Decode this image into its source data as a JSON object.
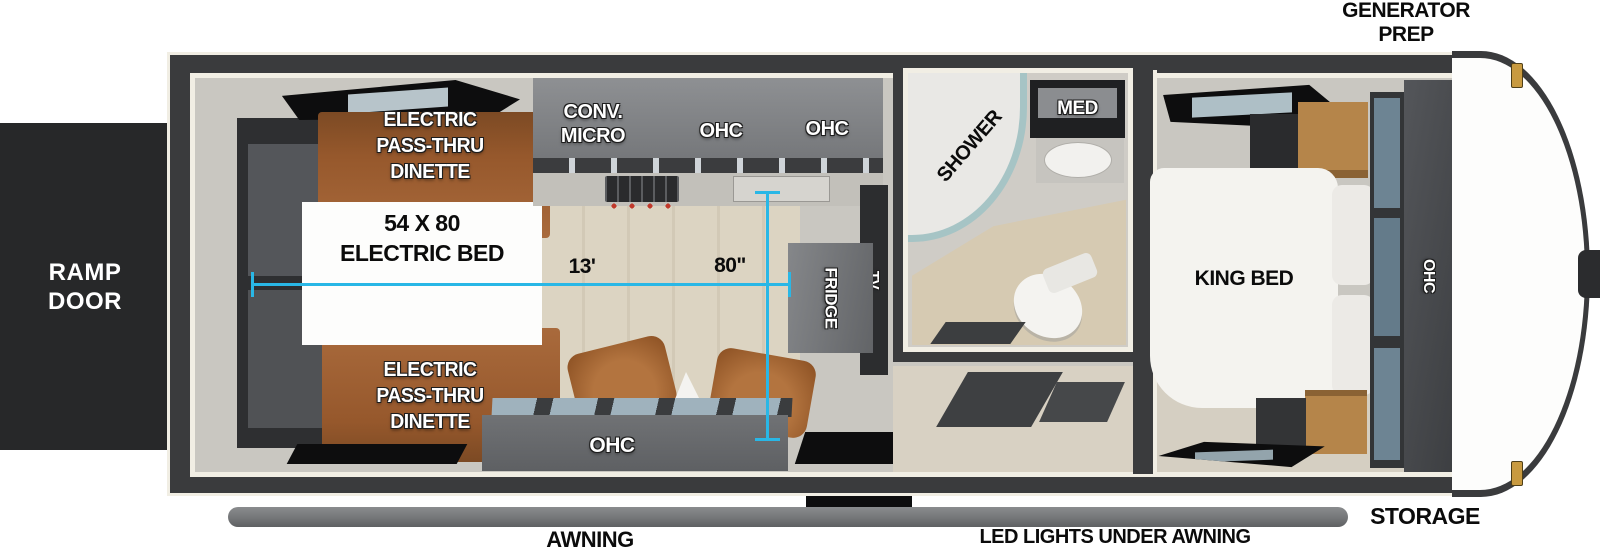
{
  "exterior": {
    "ramp_door": [
      "RAMP",
      "DOOR"
    ],
    "generator_prep": [
      "GENERATOR",
      "PREP"
    ],
    "storage": "STORAGE",
    "awning": "AWNING",
    "led_lights": "LED LIGHTS UNDER AWNING"
  },
  "garage": {
    "dinette_top": [
      "ELECTRIC",
      "PASS-THRU",
      "DINETTE"
    ],
    "dinette_bottom": [
      "ELECTRIC",
      "PASS-THRU",
      "DINETTE"
    ],
    "bed_label": [
      "54 X 80",
      "ELECTRIC BED"
    ],
    "dim_length": "13'",
    "dim_width": "80\""
  },
  "kitchen": {
    "conv_micro": [
      "CONV.",
      "MICRO"
    ],
    "ohc_left": "OHC",
    "ohc_right": "OHC",
    "ohc_sofa": "OHC",
    "fridge": "FRIDGE",
    "tv": "TV"
  },
  "bathroom": {
    "shower": "SHOWER",
    "med": "MED"
  },
  "bedroom": {
    "king_bed": "KING BED",
    "ohc": "OHC"
  },
  "colors": {
    "dim": "#29b7e6",
    "wall": "#3a3b3d",
    "trim": "#f1eee4",
    "interior": "#c9c7c1",
    "floor": "#d9d2c0",
    "brown": "#96582c",
    "brown_light": "#a96a3c",
    "cabinet": "#797b7e",
    "cabinet_dark": "#636568",
    "black": "#0d0d0e",
    "shower_glass": "#a6c4c5",
    "awning_bar": "#747678",
    "wood": "#b5854a",
    "pane": "#7b93a1",
    "white_furn": "#f5f4f1"
  }
}
